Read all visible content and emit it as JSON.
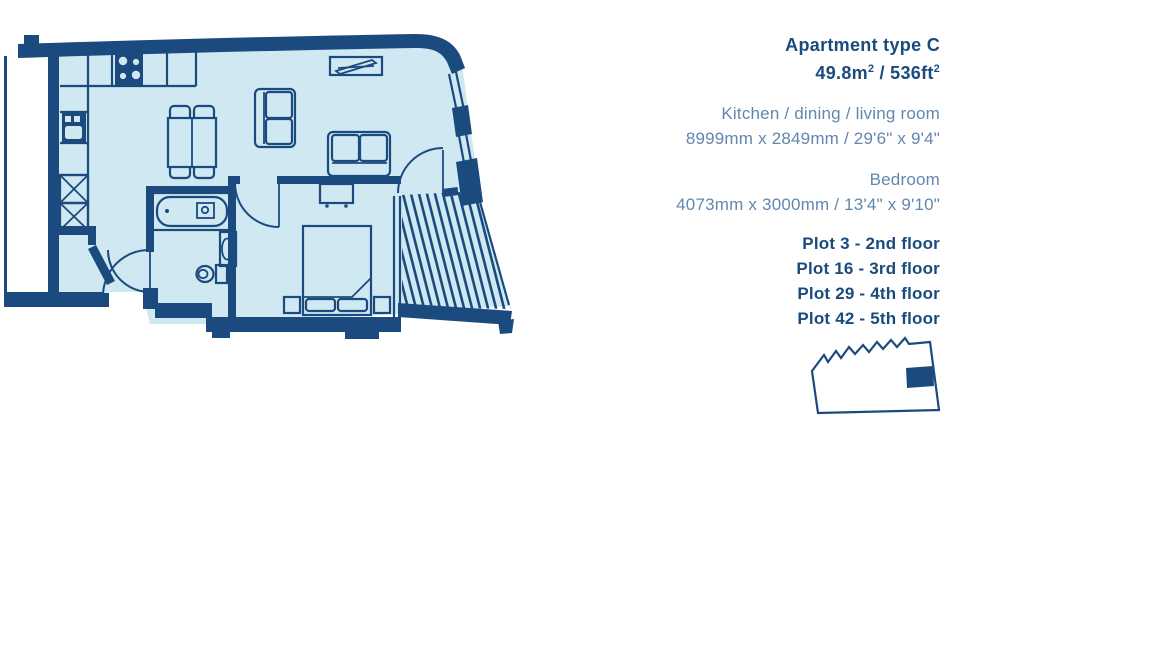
{
  "info_panel": {
    "title": "Apartment type C",
    "area": {
      "metric": "49.8m",
      "metric_sup": "2",
      "separator": " / ",
      "imperial": "536ft",
      "imperial_sup": "2"
    },
    "rooms": [
      {
        "name": "Kitchen / dining / living room",
        "dimensions": "8999mm x 2849mm / 29'6\" x 9'4\""
      },
      {
        "name": "Bedroom",
        "dimensions": "4073mm x 3000mm / 13'4\" x 9'10\""
      }
    ],
    "plots": [
      {
        "label": "Plot 3 - 2nd floor"
      },
      {
        "label": "Plot 16 - 3rd floor"
      },
      {
        "label": "Plot 29 - 4th floor"
      },
      {
        "label": "Plot 42 - 5th floor"
      }
    ]
  },
  "floorplan": {
    "features": [
      "kitchen-counter",
      "hob",
      "sink",
      "appliance-spaces",
      "dining-table-with-chairs",
      "loveseat",
      "sofa",
      "tv-unit",
      "bathtub",
      "washbasin",
      "toilet",
      "double-bed",
      "bedside-tables",
      "desk",
      "balcony-decking",
      "entrance-door",
      "internal-doors",
      "window-wall"
    ]
  },
  "keyplan": {
    "description": "building-outline-with-unit-highlight"
  },
  "colors": {
    "navy": "#1b4b7e",
    "floor": "#cfe8f1",
    "muted": "#6287ad",
    "background": "#ffffff"
  }
}
